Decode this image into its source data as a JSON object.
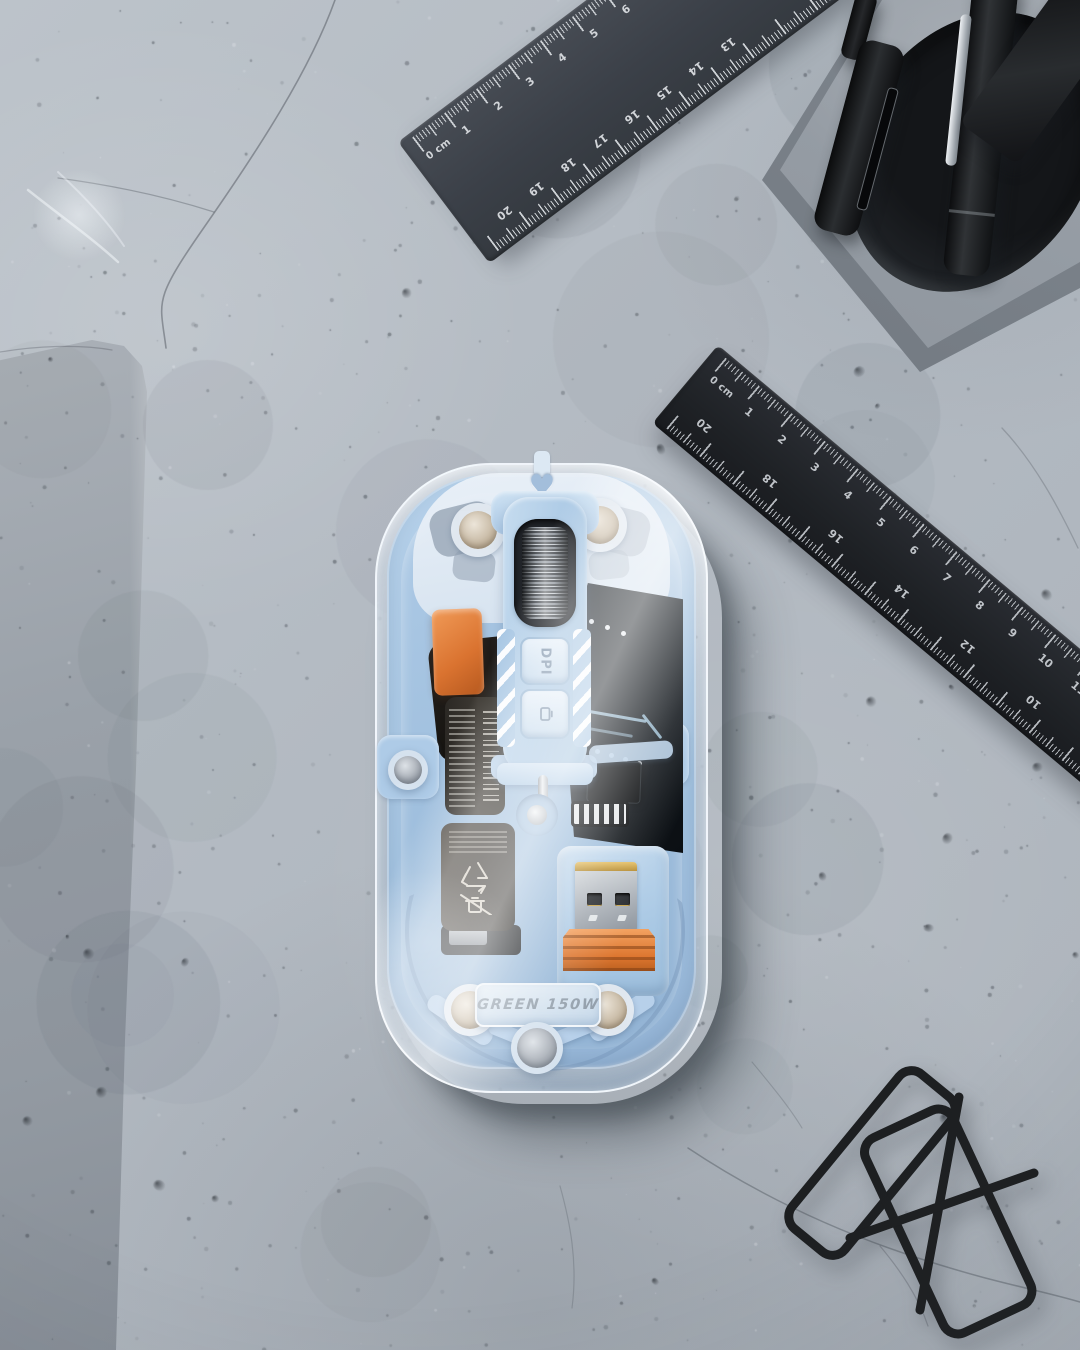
{
  "scene": {
    "description": "Top-down studio photograph of a transparent wireless computer mouse with visible internal components (scroll wheel, DPI buttons, batteries, PCB, USB receiver) lying on a light concrete surface, with two dark metal rulers, a concrete pen cup holding black pens, a gray stone slab at left, and a black wire stand at bottom right.",
    "surface": "concrete"
  },
  "palette": {
    "concrete": "#b5bcc3",
    "slab": "#99a0a8",
    "mouse_body": "#a8c6e2",
    "mouse_frame_light": "#cfe0f0",
    "accent_orange": "#dd7a33",
    "ruler_dark_gray": "#3d4249",
    "ruler_black": "#22252a",
    "metal_silver": "#c3c8cd",
    "contact_gold": "#cfa94f",
    "wire_black": "#1d1f21"
  },
  "mouse": {
    "label_text": "GREEN 150W",
    "dpi_button_label": "DPI",
    "parts": [
      "scroll-wheel",
      "dpi-button",
      "mode-button",
      "battery-barcode",
      "battery-recycle",
      "usb-receiver",
      "pcb",
      "corner-magnets",
      "screws",
      "heart-cutout"
    ]
  },
  "icons": {
    "heart": "♥",
    "recycle": "recycle-arrows",
    "crossed_bin": "crossed-out-bin",
    "barcode": "barcode-stripes",
    "mode_button": "screen-switch"
  },
  "ruler_top": {
    "unit_label": "0 cm",
    "cm_numbers": [
      "1",
      "2",
      "3",
      "4",
      "5",
      "6",
      "7",
      "8"
    ],
    "reverse_numbers": [
      "20",
      "19",
      "18",
      "17",
      "16",
      "15",
      "14",
      "13"
    ]
  },
  "ruler_right": {
    "unit_label": "0 cm",
    "cm_numbers": [
      "1",
      "2",
      "3",
      "4",
      "5",
      "6",
      "7",
      "8",
      "9",
      "10",
      "11",
      "12"
    ],
    "reverse_numbers": [
      "20",
      "18",
      "16",
      "14",
      "12",
      "10"
    ]
  }
}
